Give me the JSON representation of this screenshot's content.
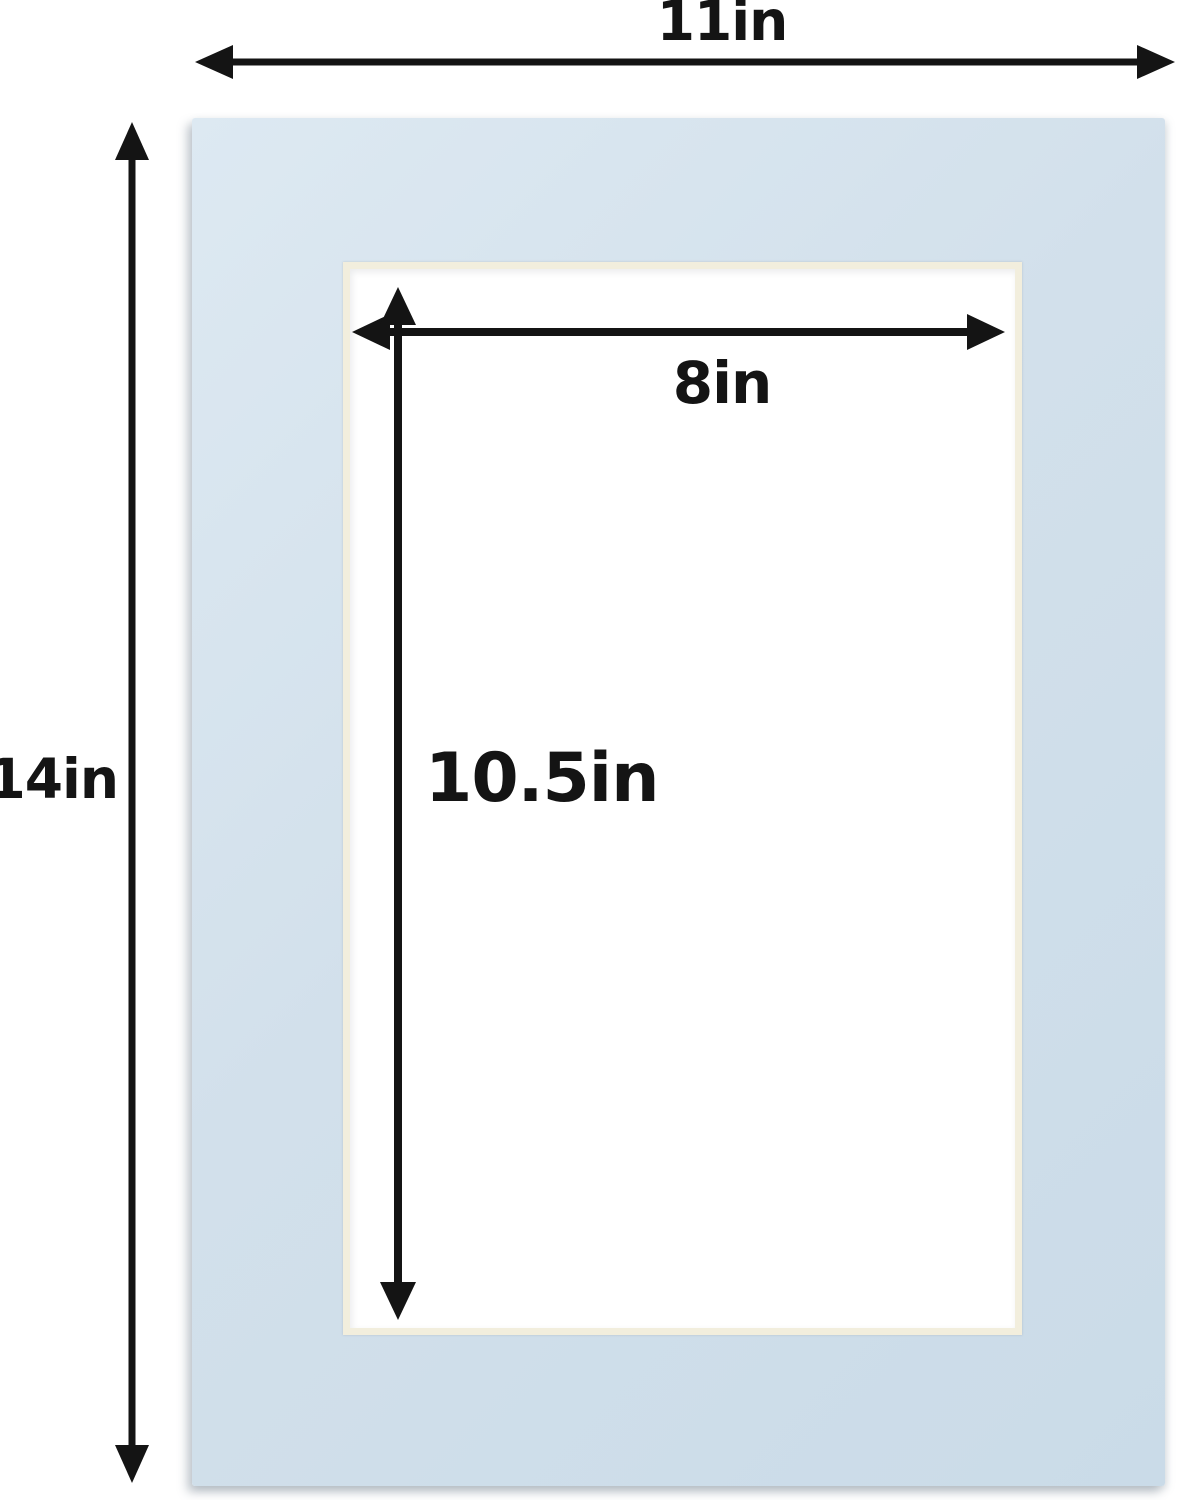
{
  "diagram": {
    "labels": {
      "outer_width": "11in",
      "outer_height": "14in",
      "opening_width": "8in",
      "opening_height": "10.5in"
    }
  },
  "colors": {
    "background": "#ffffff",
    "mat_blue": "#d2e0eb",
    "mat_blue_light": "#dde9f2",
    "mat_blue_dark": "#cadbe8",
    "bevel_cream": "#f2eedd",
    "arrow_ink": "#141414"
  }
}
